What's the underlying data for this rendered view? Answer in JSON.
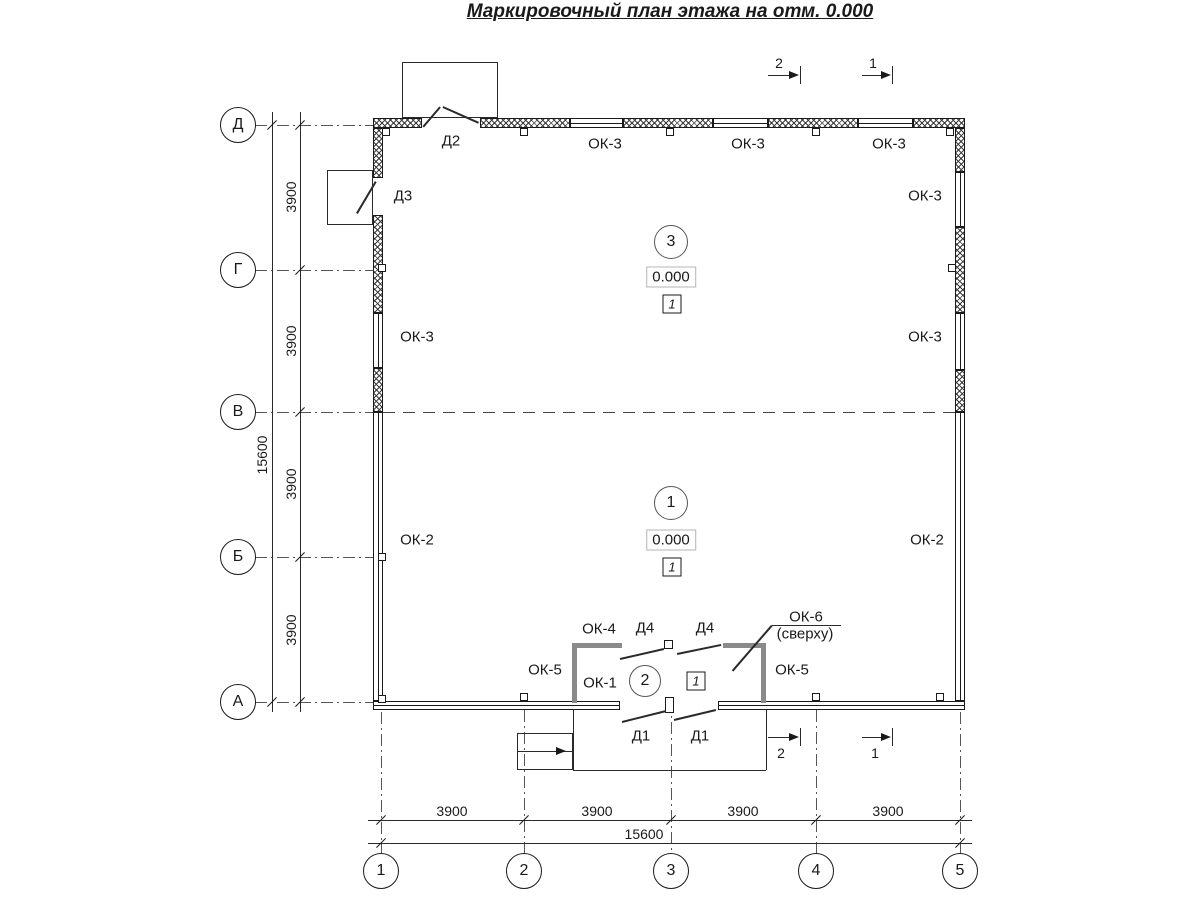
{
  "title": "Маркировочный план этажа на отм. 0.000",
  "axes": {
    "vertical": [
      "Д",
      "Г",
      "В",
      "Б",
      "А"
    ],
    "horizontal": [
      "1",
      "2",
      "3",
      "4",
      "5"
    ]
  },
  "dims": {
    "seg": "3900",
    "total": "15600"
  },
  "labels": {
    "d1": "Д1",
    "d2": "Д2",
    "d3": "Д3",
    "d4": "Д4",
    "ok1": "ОК-1",
    "ok2": "ОК-2",
    "ok3": "ОК-3",
    "ok4": "ОК-4",
    "ok5": "ОК-5",
    "ok6": "ОК-6",
    "ok6_note": "(сверху)"
  },
  "rooms": {
    "r1": {
      "number": "1",
      "elevation": "0.000",
      "floor": "1"
    },
    "r2": {
      "number": "2"
    },
    "r3": {
      "number": "3",
      "elevation": "0.000",
      "floor": "1"
    }
  },
  "sections": {
    "s1": "1",
    "s2": "2"
  },
  "colors": {
    "line": "#1a1a1a",
    "partition": "#8a8a8a"
  }
}
